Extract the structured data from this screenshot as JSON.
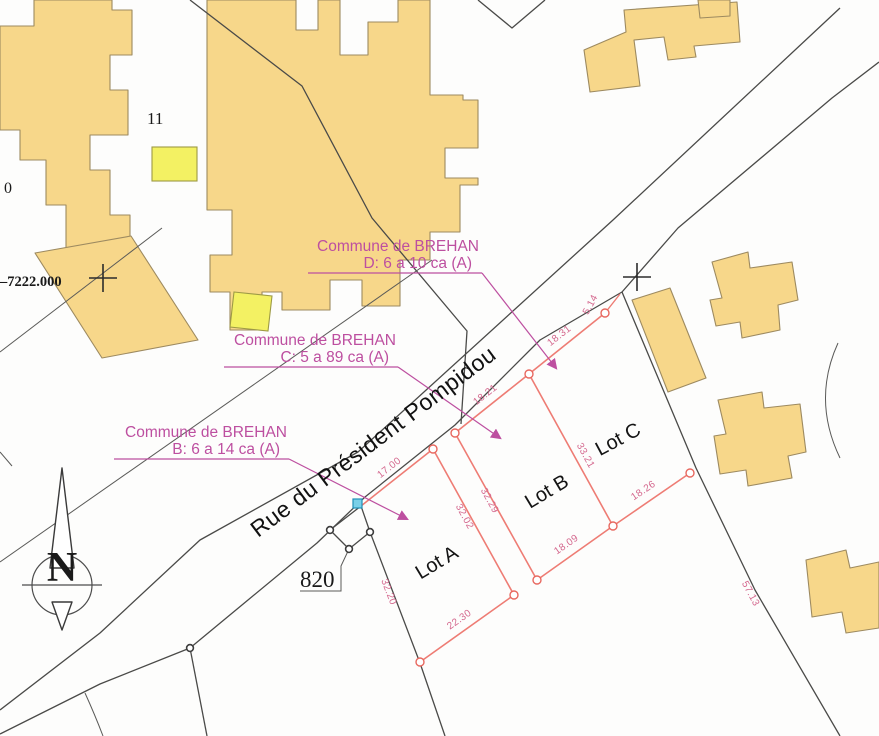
{
  "road": {
    "name": "Rue du Président Pompidou"
  },
  "annotations": {
    "d": {
      "line1": "Commune de BREHAN",
      "line2": "D: 6 a 10 ca (A)"
    },
    "c": {
      "line1": "Commune de BREHAN",
      "line2": "C: 5 a 89 ca (A)"
    },
    "b": {
      "line1": "Commune de BREHAN",
      "line2": "B: 6 a 14 ca (A)"
    }
  },
  "lots": {
    "a": "Lot A",
    "b": "Lot B",
    "c": "Lot C"
  },
  "dimensions": {
    "a_top": "17.00",
    "a_right": "32.02",
    "a_bottom": "22.30",
    "a_left": "32.20",
    "b_top": "18.21",
    "b_left": "32.29",
    "b_bottom": "18.09",
    "bc_divider": "33.21",
    "c_top": "18.31",
    "c_stub": "5.14",
    "c_bottom": "18.26",
    "east_boundary": "57.13"
  },
  "parcels": {
    "building_block": "11",
    "small_parcel": "820",
    "edge_fragment": "0"
  },
  "grid": {
    "coordinate": "–7222.000"
  },
  "compass": {
    "north": "N"
  },
  "colors": {
    "building_fill": "#f7d78a",
    "highlight_fill": "#f3f163",
    "lot_line": "#ee7c74",
    "dimension_text": "#d4688e",
    "annotation_magenta": "#bd4fa0",
    "boundary_line": "#4a4a48",
    "marker_blue": "#7ad0e8"
  }
}
